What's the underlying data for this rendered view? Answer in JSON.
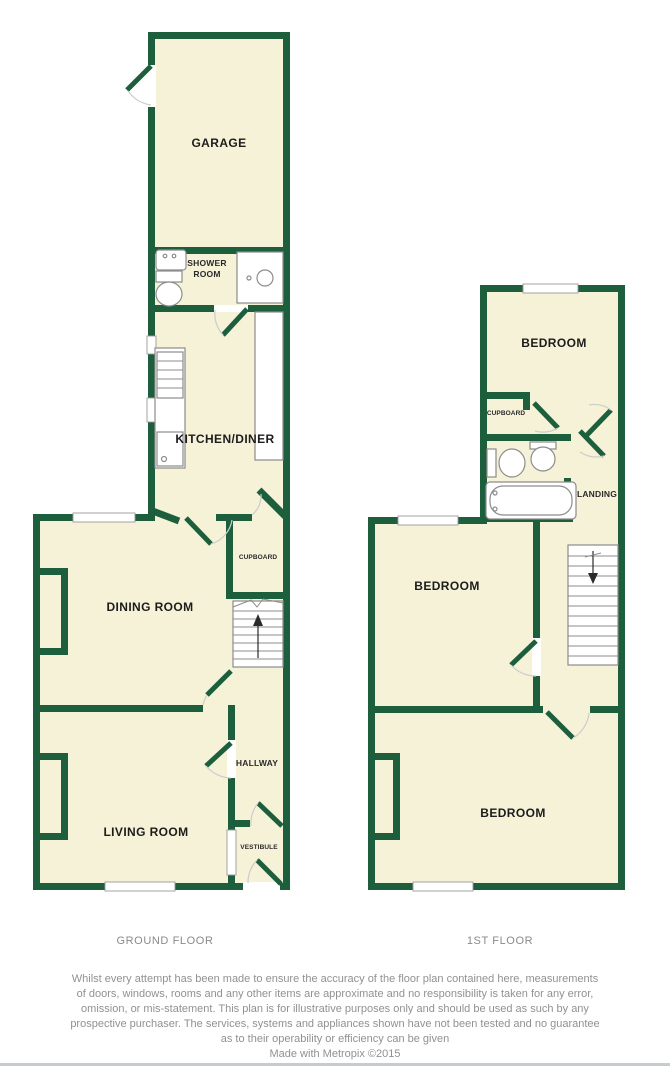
{
  "meta": {
    "type": "estate-agent floor plan",
    "credit_tool": "Metropix"
  },
  "colors": {
    "wall_green": "#1d5f3d",
    "room_fill": "#f6f2d8",
    "fixture_stroke": "#8c8c8c",
    "caption_gray": "#8a8a8a",
    "disclaimer_gray": "#919191"
  },
  "ground_floor": {
    "caption": "GROUND FLOOR",
    "rooms": {
      "garage": "GARAGE",
      "shower_room_line1": "SHOWER",
      "shower_room_line2": "ROOM",
      "kitchen_diner": "KITCHEN/DINER",
      "cupboard": "CUPBOARD",
      "dining_room": "DINING ROOM",
      "hallway": "HALLWAY",
      "living_room": "LIVING ROOM",
      "vestibule": "VESTIBULE"
    }
  },
  "first_floor": {
    "caption": "1ST FLOOR",
    "rooms": {
      "bedroom_top": "BEDROOM",
      "cupboard": "CUPBOARD",
      "landing": "LANDING",
      "bedroom_middle": "BEDROOM",
      "bedroom_bottom": "BEDROOM"
    }
  },
  "footer": {
    "disclaimer_line1": "Whilst every attempt has been made to ensure the accuracy of the floor plan contained here, measurements",
    "disclaimer_line2": "of doors, windows, rooms and any other items are approximate and no responsibility is taken for any error,",
    "disclaimer_line3": "omission, or mis-statement. This plan is for illustrative purposes only and should be used as such by any",
    "disclaimer_line4": "prospective purchaser. The services, systems and appliances shown have not been tested and no guarantee",
    "disclaimer_line5": "as to their operability or efficiency can be given",
    "credit": "Made with Metropix ©2015"
  }
}
